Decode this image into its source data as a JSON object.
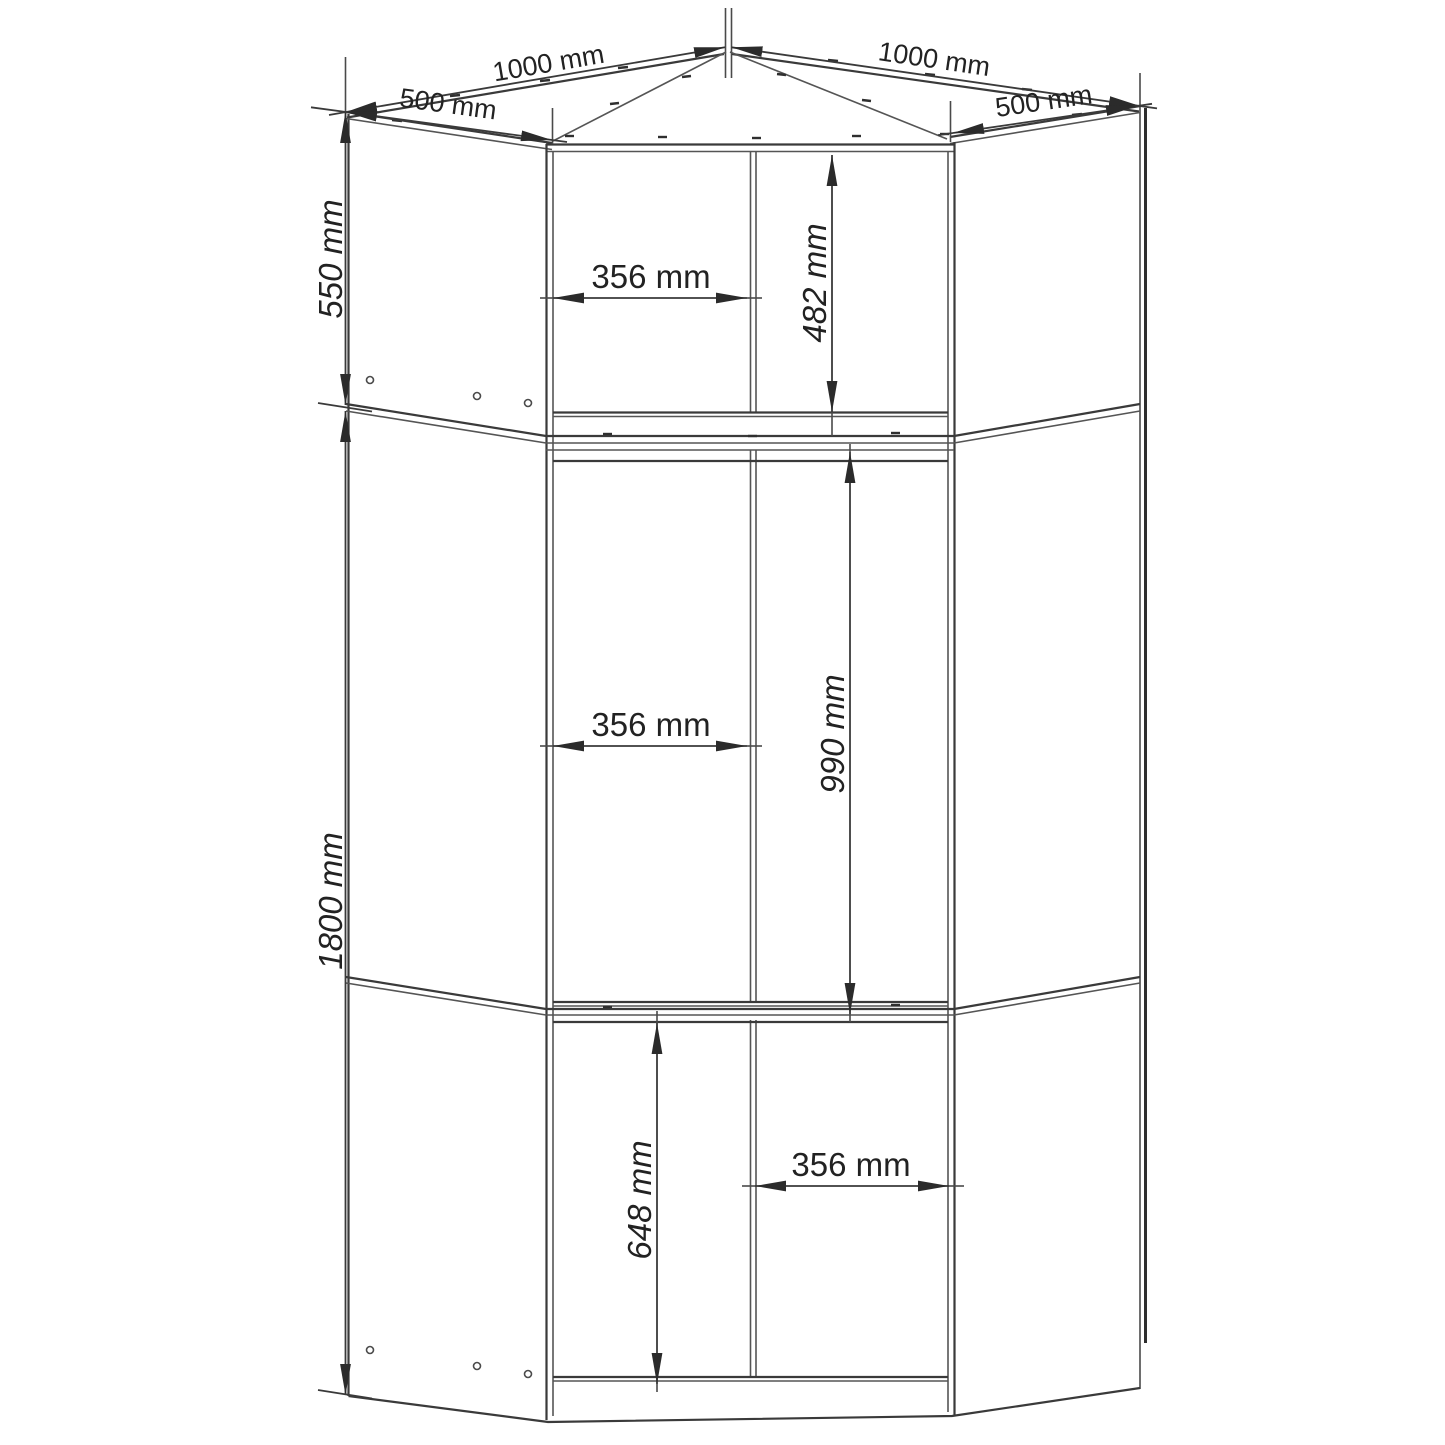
{
  "drawing": {
    "type": "furniture-technical-drawing",
    "subject": "corner wardrobe front elevation with projected top plan",
    "units": "mm",
    "dims": {
      "top_left_width": "1000 mm",
      "top_right_width": "1000 mm",
      "left_side_depth": "500 mm",
      "right_side_depth": "500 mm",
      "top_cabinet_height": "550 mm",
      "base_cabinet_height": "1800 mm",
      "top_door_width": "356 mm",
      "top_door_height": "482 mm",
      "middle_door_width": "356 mm",
      "middle_door_height": "990 mm",
      "bottom_door_height": "648 mm",
      "bottom_door_width": "356 mm"
    },
    "colors": {
      "line": "#3a3a3a",
      "background": "#ffffff"
    }
  }
}
